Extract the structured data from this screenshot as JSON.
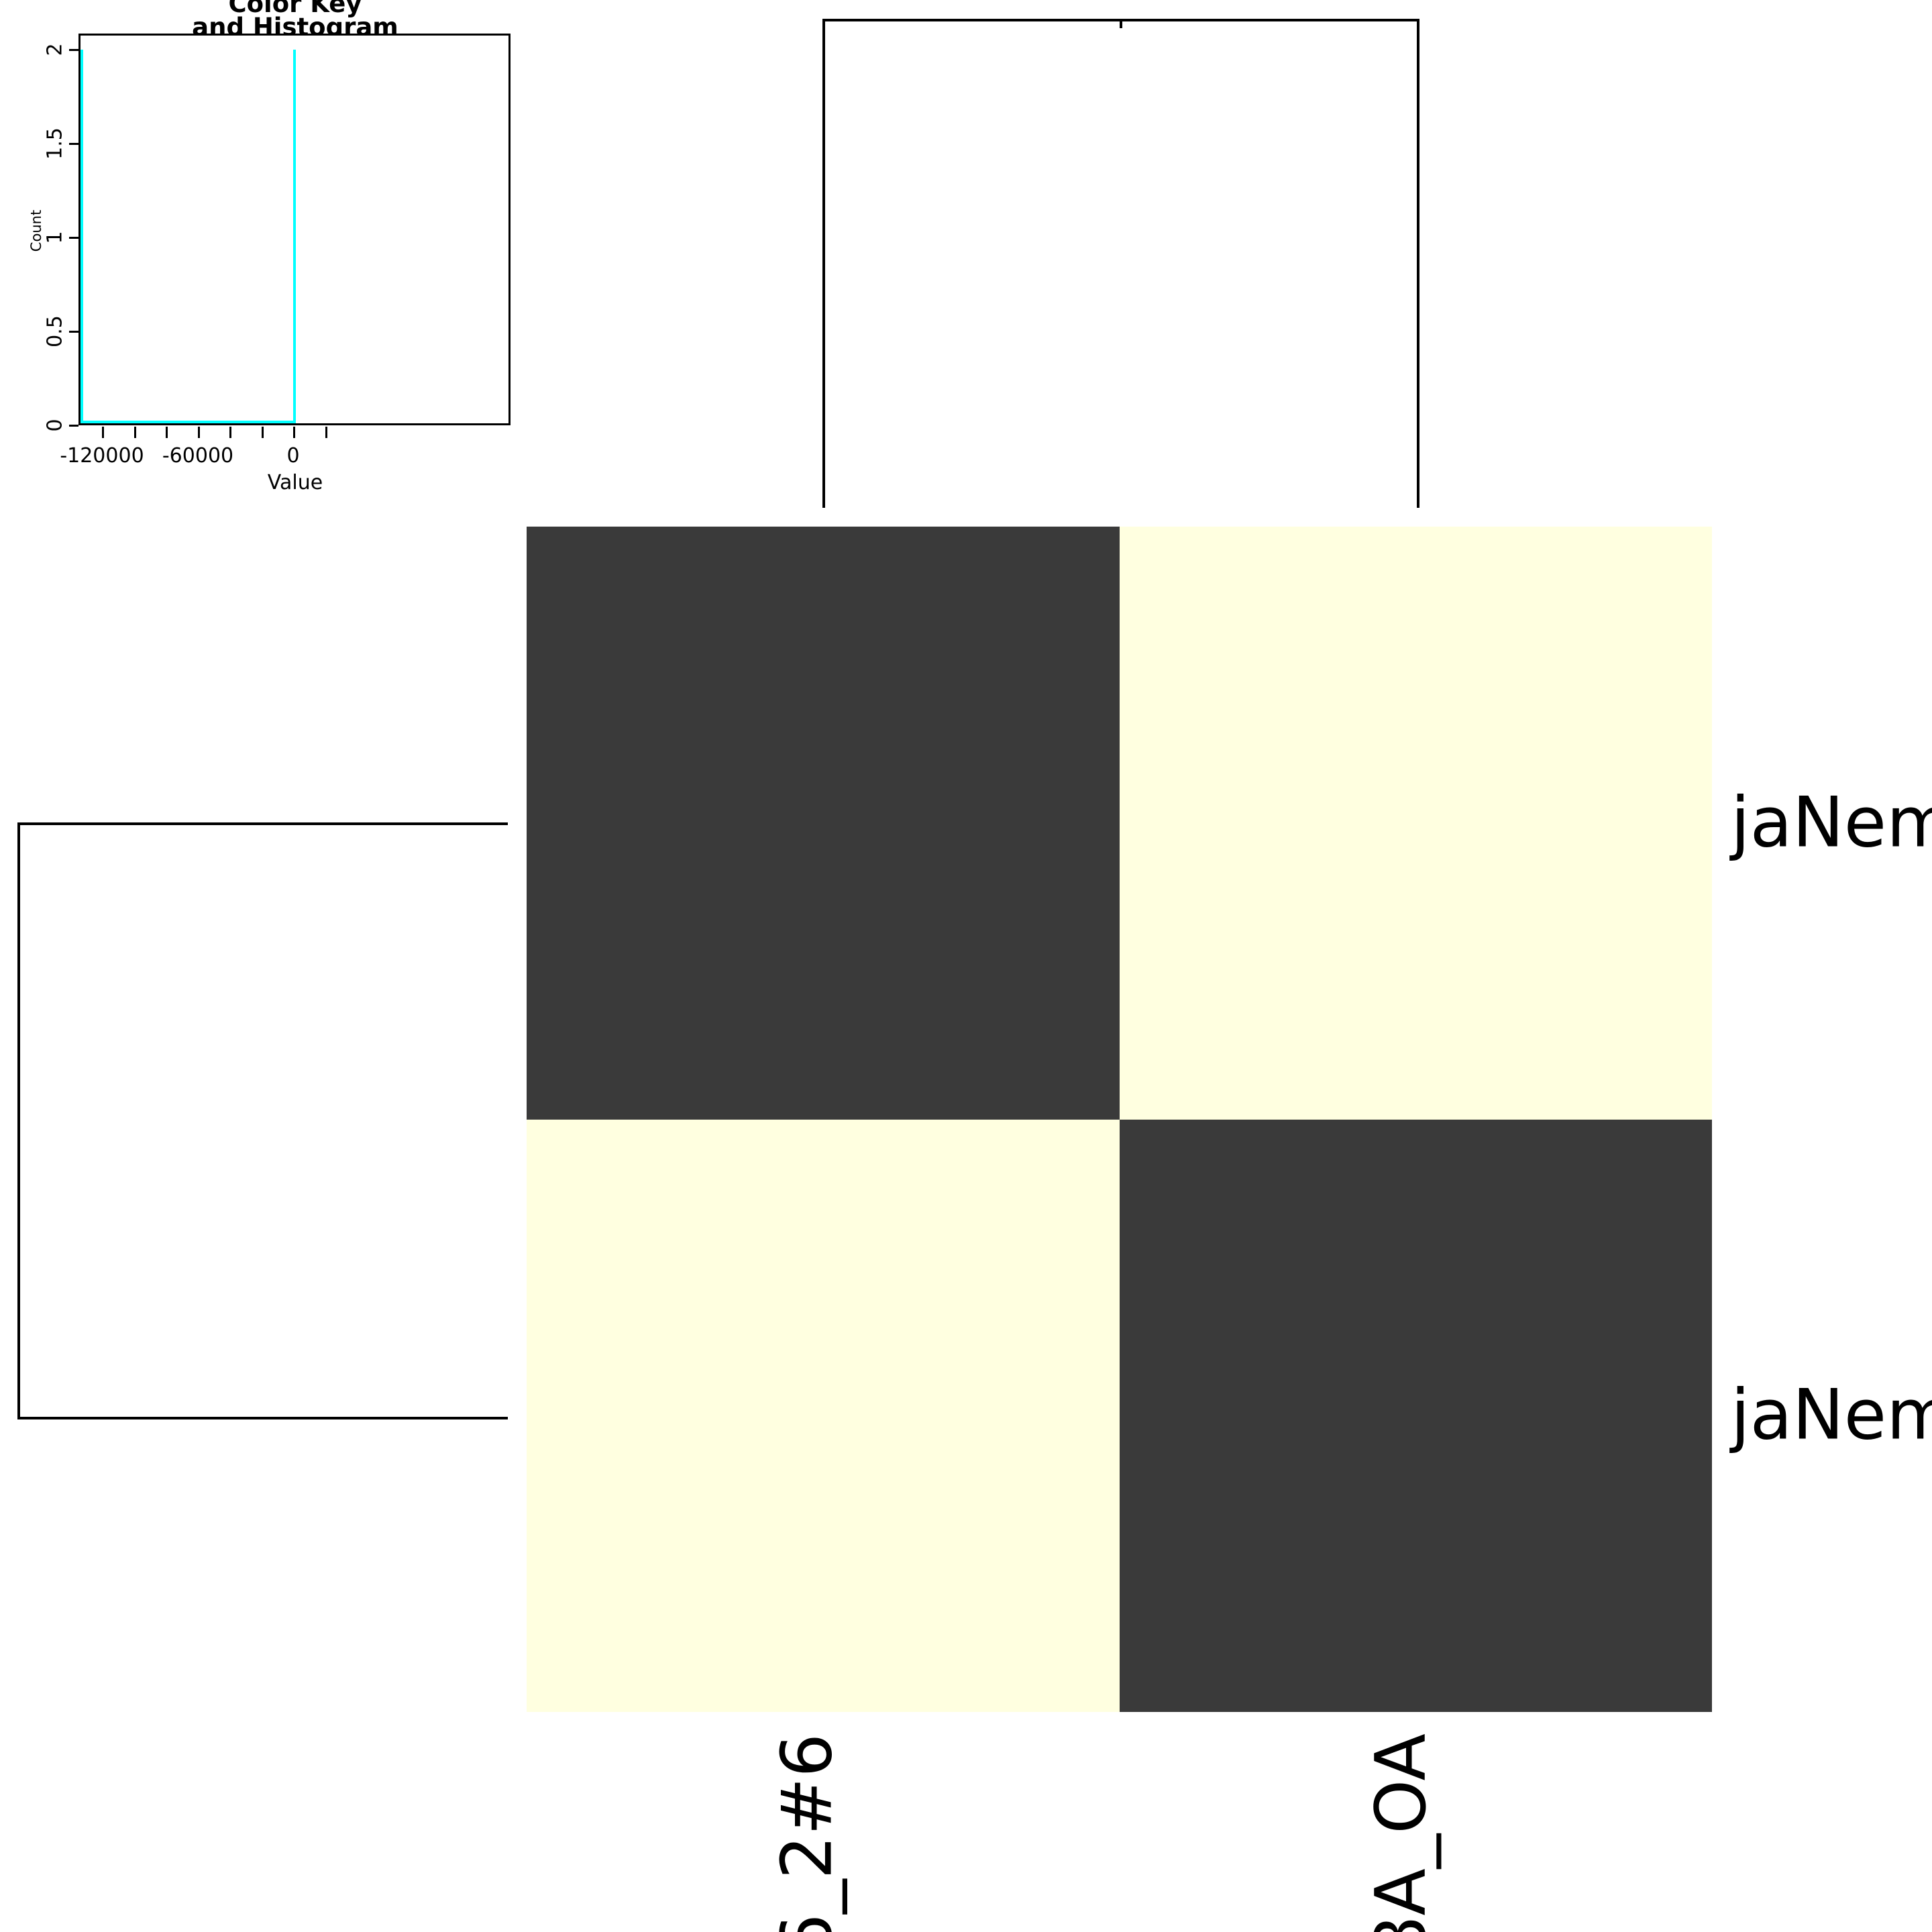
{
  "color_key": {
    "title_line1": "Color Key",
    "title_line2": "and Histogram",
    "xlabel": "Value",
    "ylabel": "Count",
    "x_tick_labels": [
      "-120000",
      "-60000",
      "0"
    ],
    "y_tick_labels": [
      "0",
      "0.5",
      "1",
      "1.5",
      "2"
    ],
    "trace_color": "#00ffff"
  },
  "heatmap": {
    "row_labels": [
      "jaNem",
      "jaNem"
    ],
    "col_labels": [
      "6_2#6",
      "8A_OA"
    ]
  },
  "chart_data": {
    "type": "heatmap",
    "rows_visible": [
      "jaNem",
      "jaNem"
    ],
    "cols_visible": [
      "6_2#6",
      "8A_OA"
    ],
    "matrix": [
      [
        0,
        -131000
      ],
      [
        -131000,
        0
      ]
    ],
    "value_colors": {
      "0": "#3a3a3a",
      "-131000": "#ffffe0"
    },
    "cell_colors": [
      [
        "#3a3a3a",
        "#ffffe0"
      ],
      [
        "#ffffe0",
        "#3a3a3a"
      ]
    ],
    "dendrograms": {
      "top": true,
      "left": true,
      "leaves": 2
    },
    "color_key_histogram": {
      "title": "Color Key and Histogram",
      "xlabel": "Value",
      "ylabel": "Count",
      "x_labeled_ticks": [
        -120000,
        -60000,
        0
      ],
      "x_minor_ticks": [
        -100000,
        -80000,
        -40000,
        -20000,
        20000
      ],
      "y_ticks": [
        0,
        0.5,
        1,
        1.5,
        2
      ],
      "xlim": [
        -135000,
        35000
      ],
      "ylim": [
        0,
        2
      ],
      "spikes": [
        {
          "x": -131000,
          "count": 2
        },
        {
          "x": 0,
          "count": 2
        }
      ],
      "trace_color": "#00ffff"
    }
  }
}
